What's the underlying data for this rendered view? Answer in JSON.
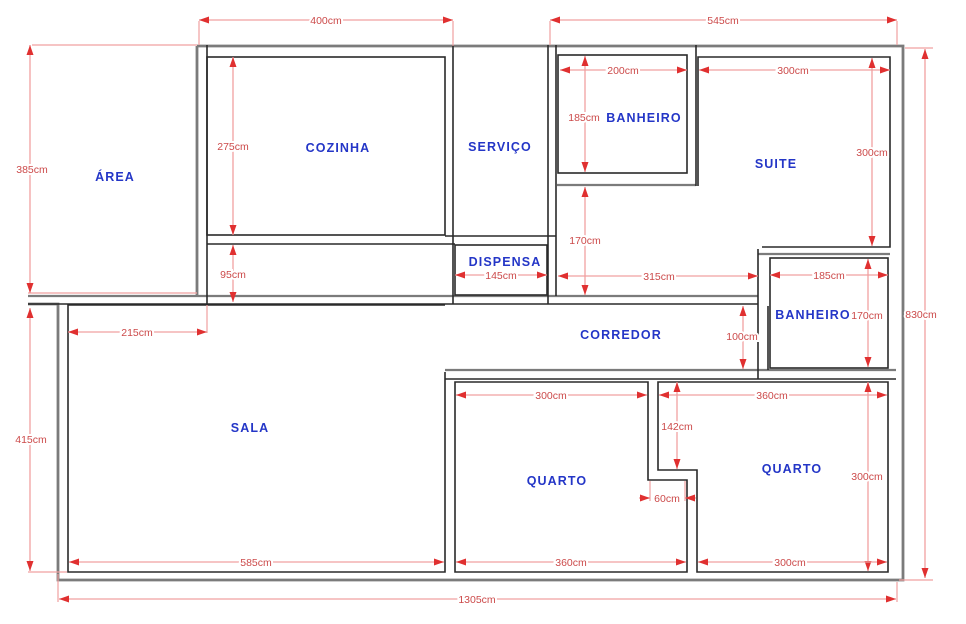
{
  "title": "Planta baixa (floor plan)",
  "colors": {
    "wall-gray": "#7b7b7b",
    "wall-dark": "#2a2a2a",
    "dim-line": "#f0a0a0",
    "dim-arrow": "#e03030",
    "dim-text": "#cc4a4a",
    "room-text": "#2436c7",
    "bg": "#ffffff"
  },
  "rooms": {
    "area": "ÁREA",
    "cozinha": "COZINHA",
    "servico": "SERVIÇO",
    "banheiro_suite": "BANHEIRO",
    "suite": "SUITE",
    "dispensa": "DISPENSA",
    "corredor": "CORREDOR",
    "banheiro_social": "BANHEIRO",
    "sala": "SALA",
    "quarto1": "QUARTO",
    "quarto2": "QUARTO"
  },
  "dimensions": {
    "cozinha_block_width": "400cm",
    "right_wing_width": "545cm",
    "area_height": "385cm",
    "cozinha_height": "275cm",
    "banheiro_suite_width": "200cm",
    "suite_width": "300cm",
    "banheiro_suite_height": "185cm",
    "suite_height": "300cm",
    "passage_height": "95cm",
    "hall_height": "170cm",
    "sala_left_offset": "215cm",
    "dispensa_width": "145cm",
    "hall_width": "315cm",
    "banheiro_social_width": "185cm",
    "banheiro_social_height": "170cm",
    "total_height": "830cm",
    "sala_height": "415cm",
    "corredor_height": "100cm",
    "closet_depth": "142cm",
    "quarto1_top_width": "300cm",
    "quarto2_top_width": "360cm",
    "closet_width": "60cm",
    "quarto2_height": "300cm",
    "sala_width": "585cm",
    "quarto1_bottom_width": "360cm",
    "quarto2_bottom_width": "300cm",
    "total_width": "1305cm"
  }
}
